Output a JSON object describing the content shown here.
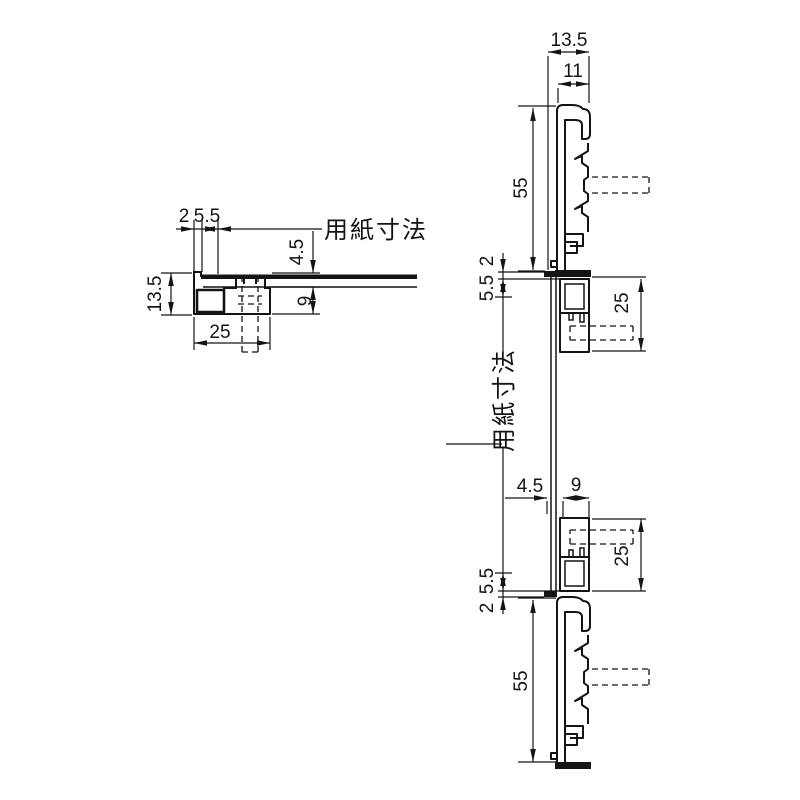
{
  "left_view": {
    "dim_2": "2",
    "dim_5_5": "5.5",
    "paper_label": "用紙寸法",
    "dim_4_5": "4.5",
    "dim_13_5": "13.5",
    "dim_9": "9",
    "dim_25": "25"
  },
  "right_view": {
    "dim_13_5": "13.5",
    "dim_11": "11",
    "dim_55_top": "55",
    "dim_2_top": "2",
    "dim_5_5_top": "5.5",
    "dim_25_top": "25",
    "paper_label": "用紙寸法",
    "dim_4_5": "4.5",
    "dim_9": "9",
    "dim_25_bottom": "25",
    "dim_5_5_bottom": "5.5",
    "dim_2_bottom": "2",
    "dim_55_bottom": "55"
  },
  "colors": {
    "line": "#141414",
    "background": "#ffffff"
  }
}
